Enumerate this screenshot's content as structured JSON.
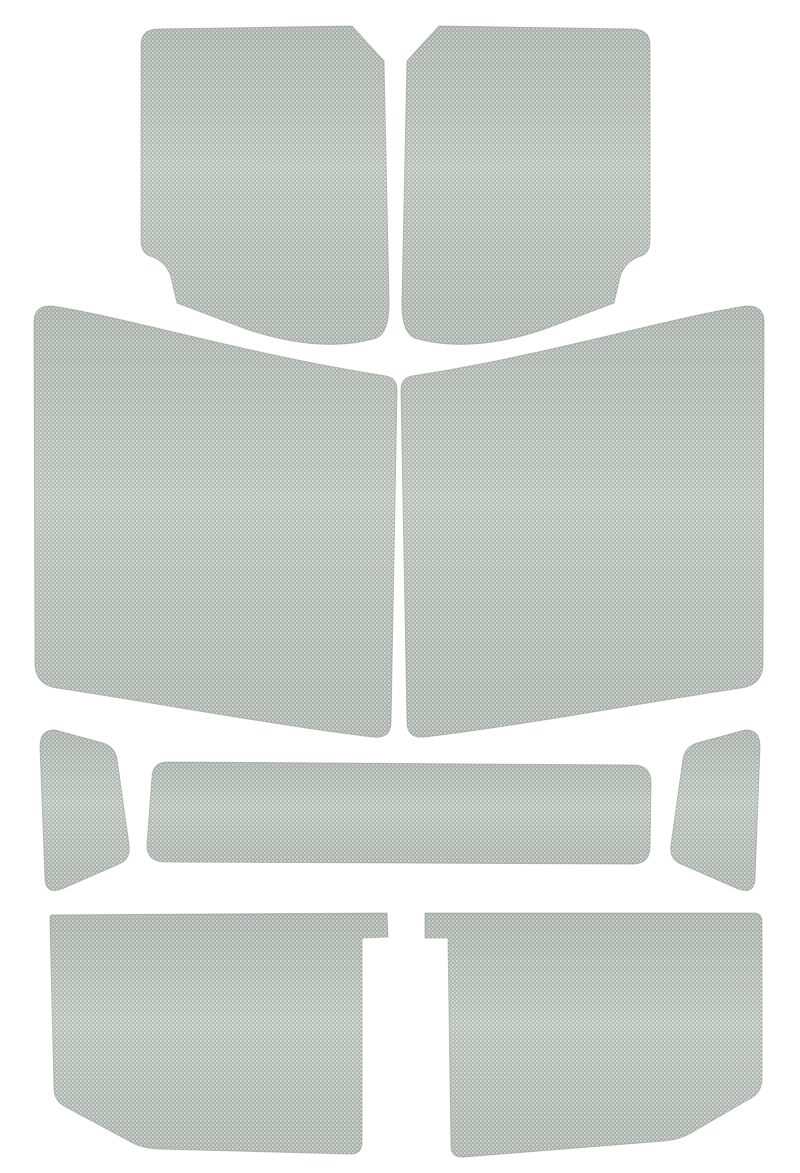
{
  "page": {
    "title": "Product photo: nine die-cut pieces of light gray woven headliner fabric arranged on a white background",
    "background_color": "#ffffff"
  },
  "canvas": {
    "width": 800,
    "height": 1173
  },
  "colors": {
    "background": "#ffffff",
    "fabric_mid": "#aeb5ae",
    "fabric_light": "#d2d7d1",
    "fabric_light_alt": "#c5ccc5",
    "fabric_edge": "#8d968f"
  },
  "pieces": [
    {
      "id": "front-panel-left",
      "label": "Front headliner panel, left",
      "path": "M 159 29 L 352 26 L 384 61 L 389 300 Q 390 336 373 339 C 333 350 287 343 246 329 L 177 303 L 171 277 Q 166 261 150 256 Q 141 253 141 240 L 141 45 Q 141 29 159 29 Z"
    },
    {
      "id": "front-panel-right",
      "label": "Front headliner panel, right",
      "path": "M 439 26 L 632 29 Q 650 29 650 45 L 650 240 Q 650 253 641 256 Q 625 261 620 277 L 614 303 L 545 329 C 504 343 458 350 418 339 Q 401 336 402 300 L 407 61 Z"
    },
    {
      "id": "rear-side-panel-left",
      "label": "Rear side panel, left",
      "path": "M 52 306 C 130 318 250 355 386 376 Q 397 378 397 390 L 391 722 Q 391 739 373 737 C 280 726 150 702 57 688 Q 36 685 35 665 L 34 322 Q 34 305 52 306 Z"
    },
    {
      "id": "rear-side-panel-right",
      "label": "Rear side panel, right",
      "path": "M 746 306 C 668 318 548 355 412 376 Q 401 378 401 390 L 407 722 Q 407 739 425 737 C 518 726 648 702 741 688 Q 762 685 763 665 L 764 322 Q 764 305 746 306 Z"
    },
    {
      "id": "sail-panel-left",
      "label": "Small side panel, left",
      "path": "M 55 730 L 103 743 Q 115 747 117 759 L 129 845 Q 131 859 119 864 L 64 888 Q 46 896 45 879 L 40 747 Q 40 729 55 730 Z"
    },
    {
      "id": "center-bar-panel",
      "label": "Wide center strip panel",
      "path": "M 170 762 L 633 765 Q 651 765 651 783 L 650 846 Q 650 865 631 864 L 166 862 Q 146 862 147 844 L 152 777 Q 153 761 170 762 Z"
    },
    {
      "id": "sail-panel-right",
      "label": "Small side panel, right",
      "path": "M 745 730 L 697 743 Q 685 747 683 759 L 671 845 Q 669 859 681 864 L 736 888 Q 754 896 755 879 L 760 747 Q 760 729 745 730 Z"
    },
    {
      "id": "tailgate-panel-left",
      "label": "Tailgate panel, left",
      "path": "M 51 915 L 387 913 L 388 937 L 362 938 L 362 1142 Q 362 1155 349 1154 L 158 1149 Q 141 1148 131 1142 L 64 1106 Q 54 1100 54 1088 L 50 922 Q 50 915 51 915 Z"
    },
    {
      "id": "tailgate-panel-right",
      "label": "Tailgate panel, right",
      "path": "M 425 913 L 754 913 Q 762 913 762 922 L 762 1078 Q 762 1091 753 1097 L 691 1133 Q 679 1140 664 1141 L 464 1157 Q 451 1158 451 1146 L 448 938 L 425 938 Z"
    }
  ]
}
